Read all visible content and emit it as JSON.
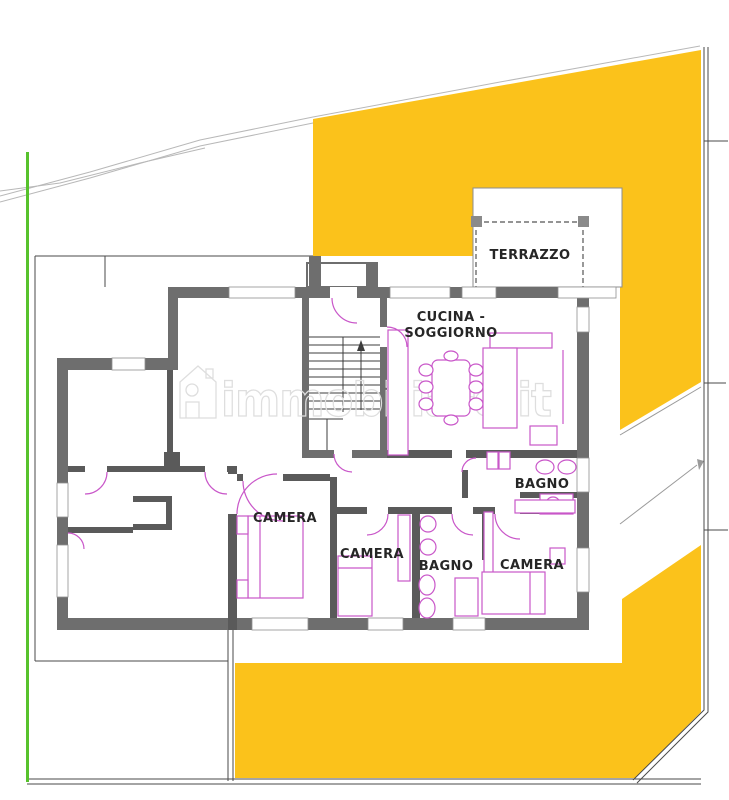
{
  "canvas": {
    "width": 729,
    "height": 800
  },
  "colors": {
    "area_yellow": "#fbc21b",
    "site_green": "#57c22c",
    "wall_gray": "#6e6e6e",
    "interior_wall_gray": "#5a5a5a",
    "furniture_magenta": "#c957c9",
    "label_dark": "#262626",
    "watermark_gray": "#dedede",
    "boundary_gray": "#4a4a4a"
  },
  "labels": {
    "terrazzo": "TERRAZZO",
    "cucina_line1": "CUCINA -",
    "cucina_line2": "SOGGIORNO",
    "bagno_main": "BAGNO",
    "camera_left": "CAMERA",
    "camera_center": "CAMERA",
    "bagno_center": "BAGNO",
    "camera_right": "CAMERA"
  },
  "watermark": {
    "text": "immobiliare.it"
  }
}
